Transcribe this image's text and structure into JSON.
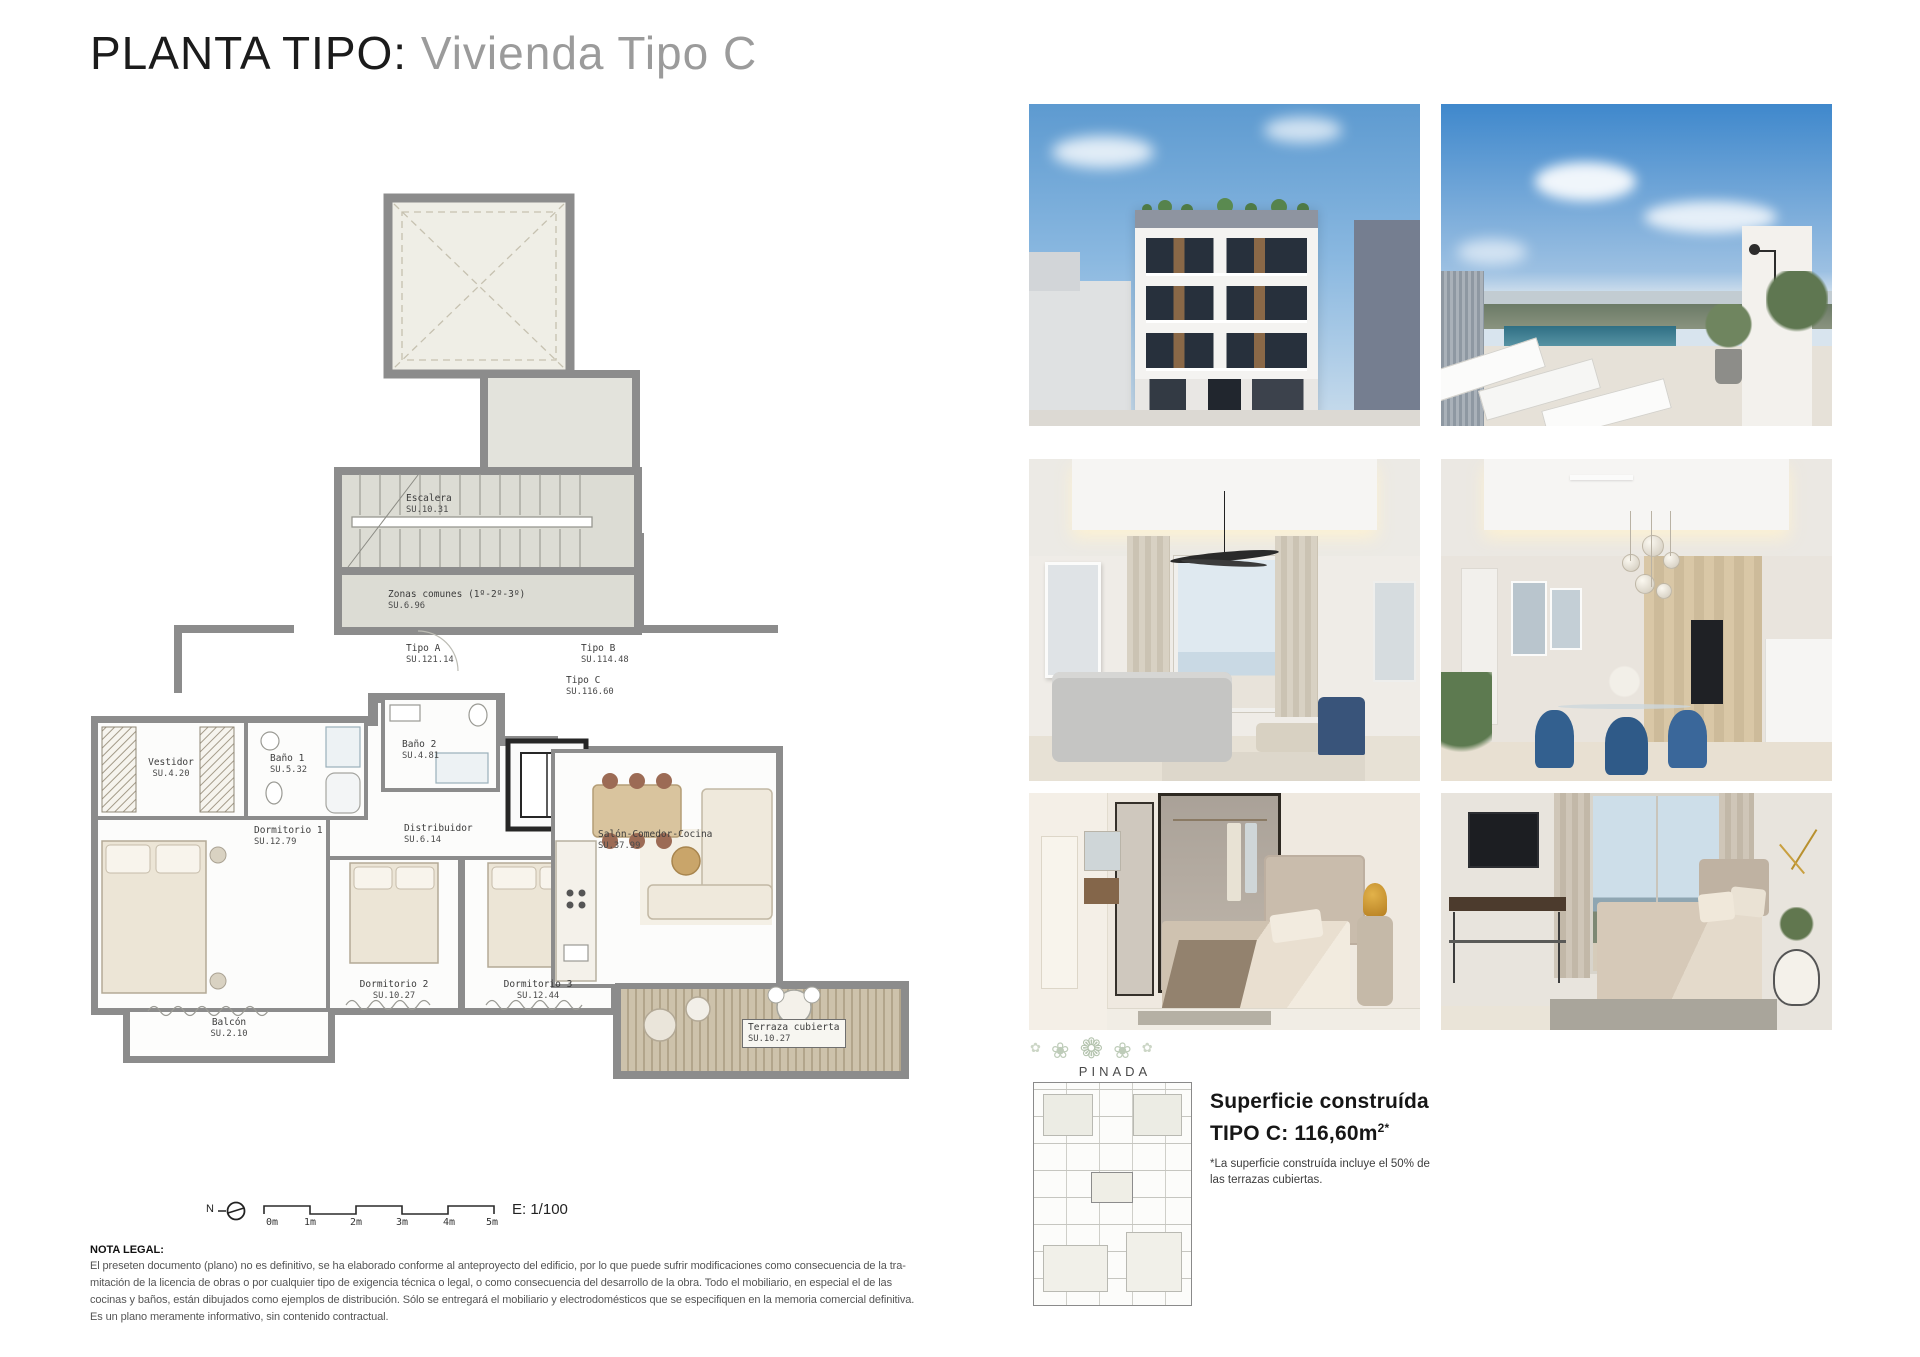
{
  "page": {
    "title_black": "PLANTA TIPO:",
    "title_gray": " Vivienda Tipo C"
  },
  "plan": {
    "rooms": [
      {
        "name": "Escalera",
        "area": "SU.10.31"
      },
      {
        "name": "Zonas comunes (1º-2º-3º)",
        "area": "SU.6.96"
      },
      {
        "name": "Tipo A",
        "area": "SU.121.14"
      },
      {
        "name": "Tipo B",
        "area": "SU.114.48"
      },
      {
        "name": "Tipo C",
        "area": "SU.116.60"
      },
      {
        "name": "Vestidor",
        "area": "SU.4.20"
      },
      {
        "name": "Baño 1",
        "area": "SU.5.32"
      },
      {
        "name": "Baño 2",
        "area": "SU.4.81"
      },
      {
        "name": "Dormitorio 1",
        "area": "SU.12.79"
      },
      {
        "name": "Distribuidor",
        "area": "SU.6.14"
      },
      {
        "name": "Salón-Comedor-Cocina",
        "area": "SU.37.99"
      },
      {
        "name": "Dormitorio 2",
        "area": "SU.10.27"
      },
      {
        "name": "Dormitorio 3",
        "area": "SU.12.44"
      },
      {
        "name": "Balcón",
        "area": "SU.2.10"
      },
      {
        "name": "Terraza cubierta",
        "area": "SU.10.27"
      }
    ],
    "north_label": "N",
    "scale_ticks": [
      "0m",
      "1m",
      "2m",
      "3m",
      "4m",
      "5m"
    ],
    "scale_ratio": "E: 1/100"
  },
  "gallery": {
    "photo_ids": [
      "building-facade-render",
      "rooftop-pool-render",
      "living-room-render",
      "dining-kitchen-render",
      "bedroom-suite-render",
      "bedroom-view-render"
    ]
  },
  "brand": {
    "decor": "❀ ✿ ❁ ✿ ❀",
    "name": "PINADA"
  },
  "summary": {
    "heading_line1": "Superficie construída",
    "heading_line2": "TIPO C: 116,60m",
    "heading_sup": "2*",
    "footnote_line1": "*La superficie construída incluye el 50% de",
    "footnote_line2": "las terrazas cubiertas."
  },
  "legal": {
    "heading": "NOTA LEGAL:",
    "line1": "El preseten documento (plano) no es definitivo, se ha elaborado conforme al anteproyecto del edificio, por lo que puede sufrir modificaciones como consecuencia de la tra-",
    "line2": "mitación de la licencia de obras o por cualquier tipo de exigencia técnica o legal, o como consecuencia del desarrollo de la obra. Todo el mobiliario, en especial el de las",
    "line3": "cocinas y baños, están dibujados como ejemplos de distribución. Sólo se entregará el mobiliario y electrodomésticos que se especifiquen en la memoria comercial definitiva.",
    "line4": "Es un plano meramente informativo, sin contenido contractual."
  },
  "colors": {
    "title_gray": "#9b9b9b",
    "wall_gray": "#8c8c8c",
    "common_fill": "#dcdcd4",
    "patio_fill": "#efeee6",
    "deck_tan": "#cdc2ab",
    "sky_blue": "#5d9ad0"
  }
}
